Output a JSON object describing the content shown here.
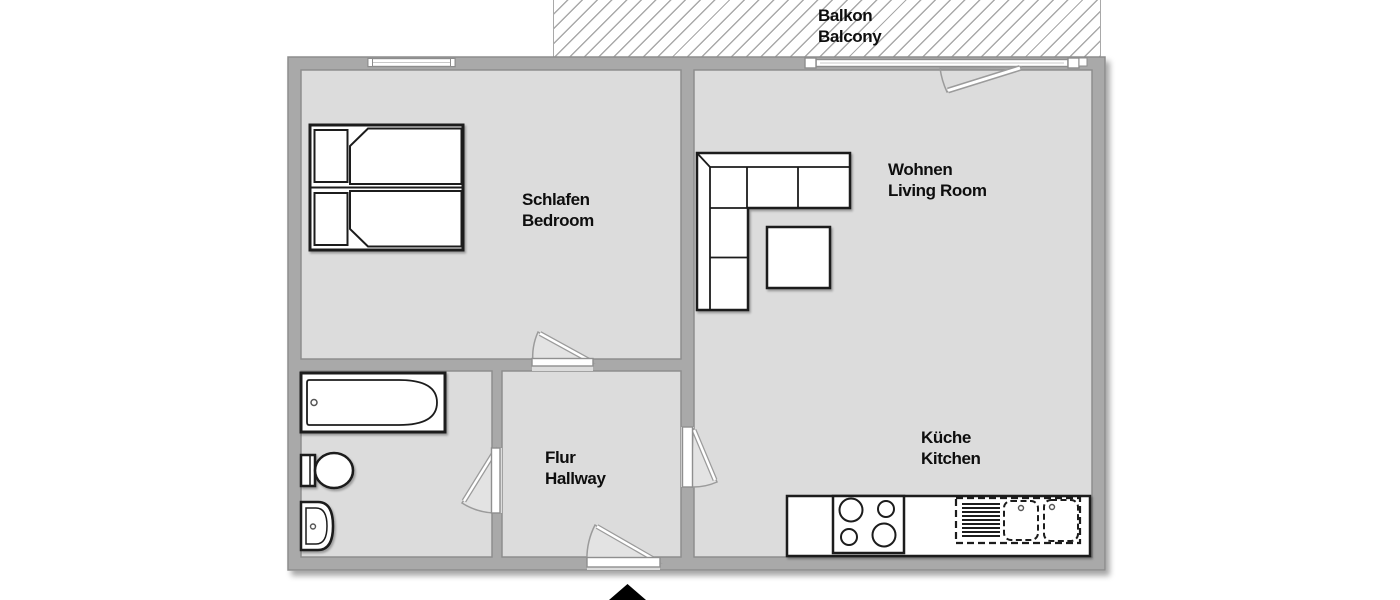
{
  "rooms": {
    "balcony": {
      "de": "Balkon",
      "en": "Balcony"
    },
    "bedroom": {
      "de": "Schlafen",
      "en": "Bedroom"
    },
    "living": {
      "de": "Wohnen",
      "en": "Living Room"
    },
    "kitchen": {
      "de": "Küche",
      "en": "Kitchen"
    },
    "hallway": {
      "de": "Flur",
      "en": "Hallway"
    }
  },
  "colors": {
    "wall": "#a9a9a9",
    "wall_edge": "#8d8d8d",
    "floor": "#dcdcdc",
    "furniture_line": "#1a1a1a",
    "label_text": "#0e0e0e"
  }
}
